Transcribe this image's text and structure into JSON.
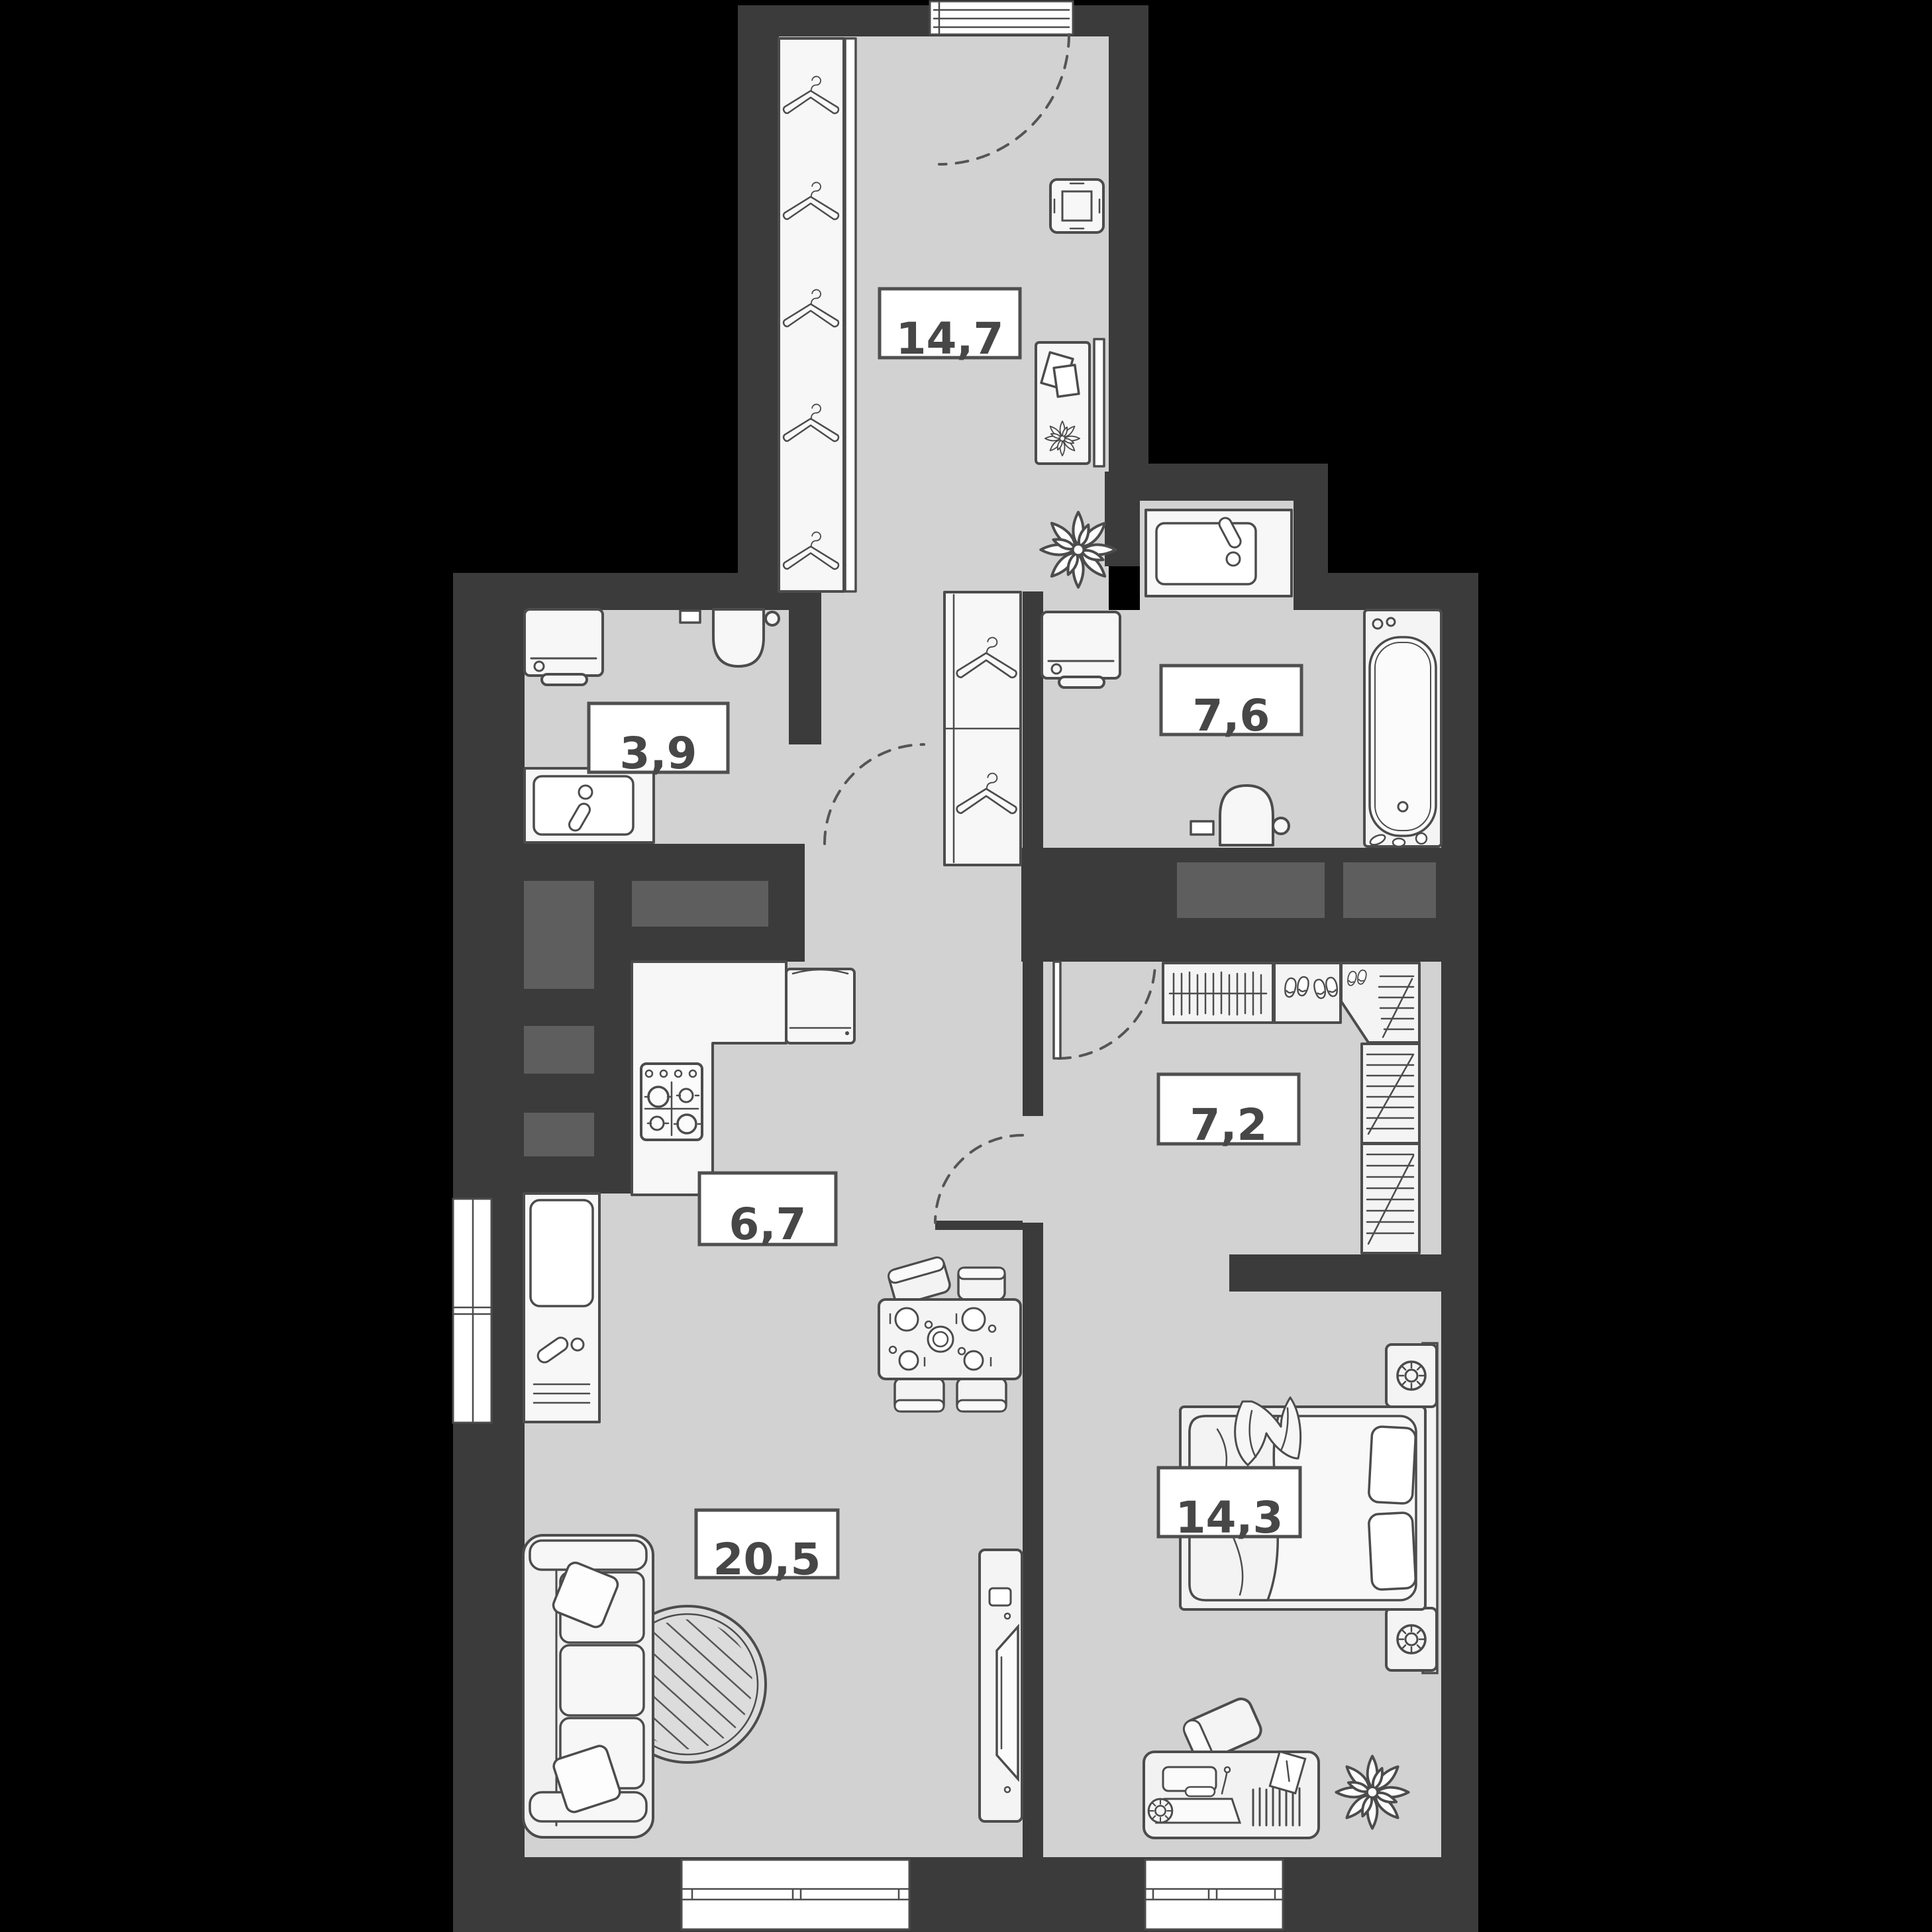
{
  "page": {
    "title": "Apartment floor plan"
  },
  "colors": {
    "background": "#000000",
    "wall": "#3b3b3b",
    "floor": "#d2d2d2",
    "shaft": "#5e5e5e",
    "furniture": "#f4f4f4",
    "outline": "#4c4c4c",
    "label_bg": "#ffffff",
    "label_text": "#474747"
  },
  "rooms": [
    {
      "id": "hallway",
      "area_label": "14,7"
    },
    {
      "id": "wc",
      "area_label": "3,9"
    },
    {
      "id": "bathroom",
      "area_label": "7,6"
    },
    {
      "id": "kitchen",
      "area_label": "6,7"
    },
    {
      "id": "wardrobe",
      "area_label": "7,2"
    },
    {
      "id": "living_room",
      "area_label": "20,5"
    },
    {
      "id": "bedroom",
      "area_label": "14,3"
    }
  ]
}
